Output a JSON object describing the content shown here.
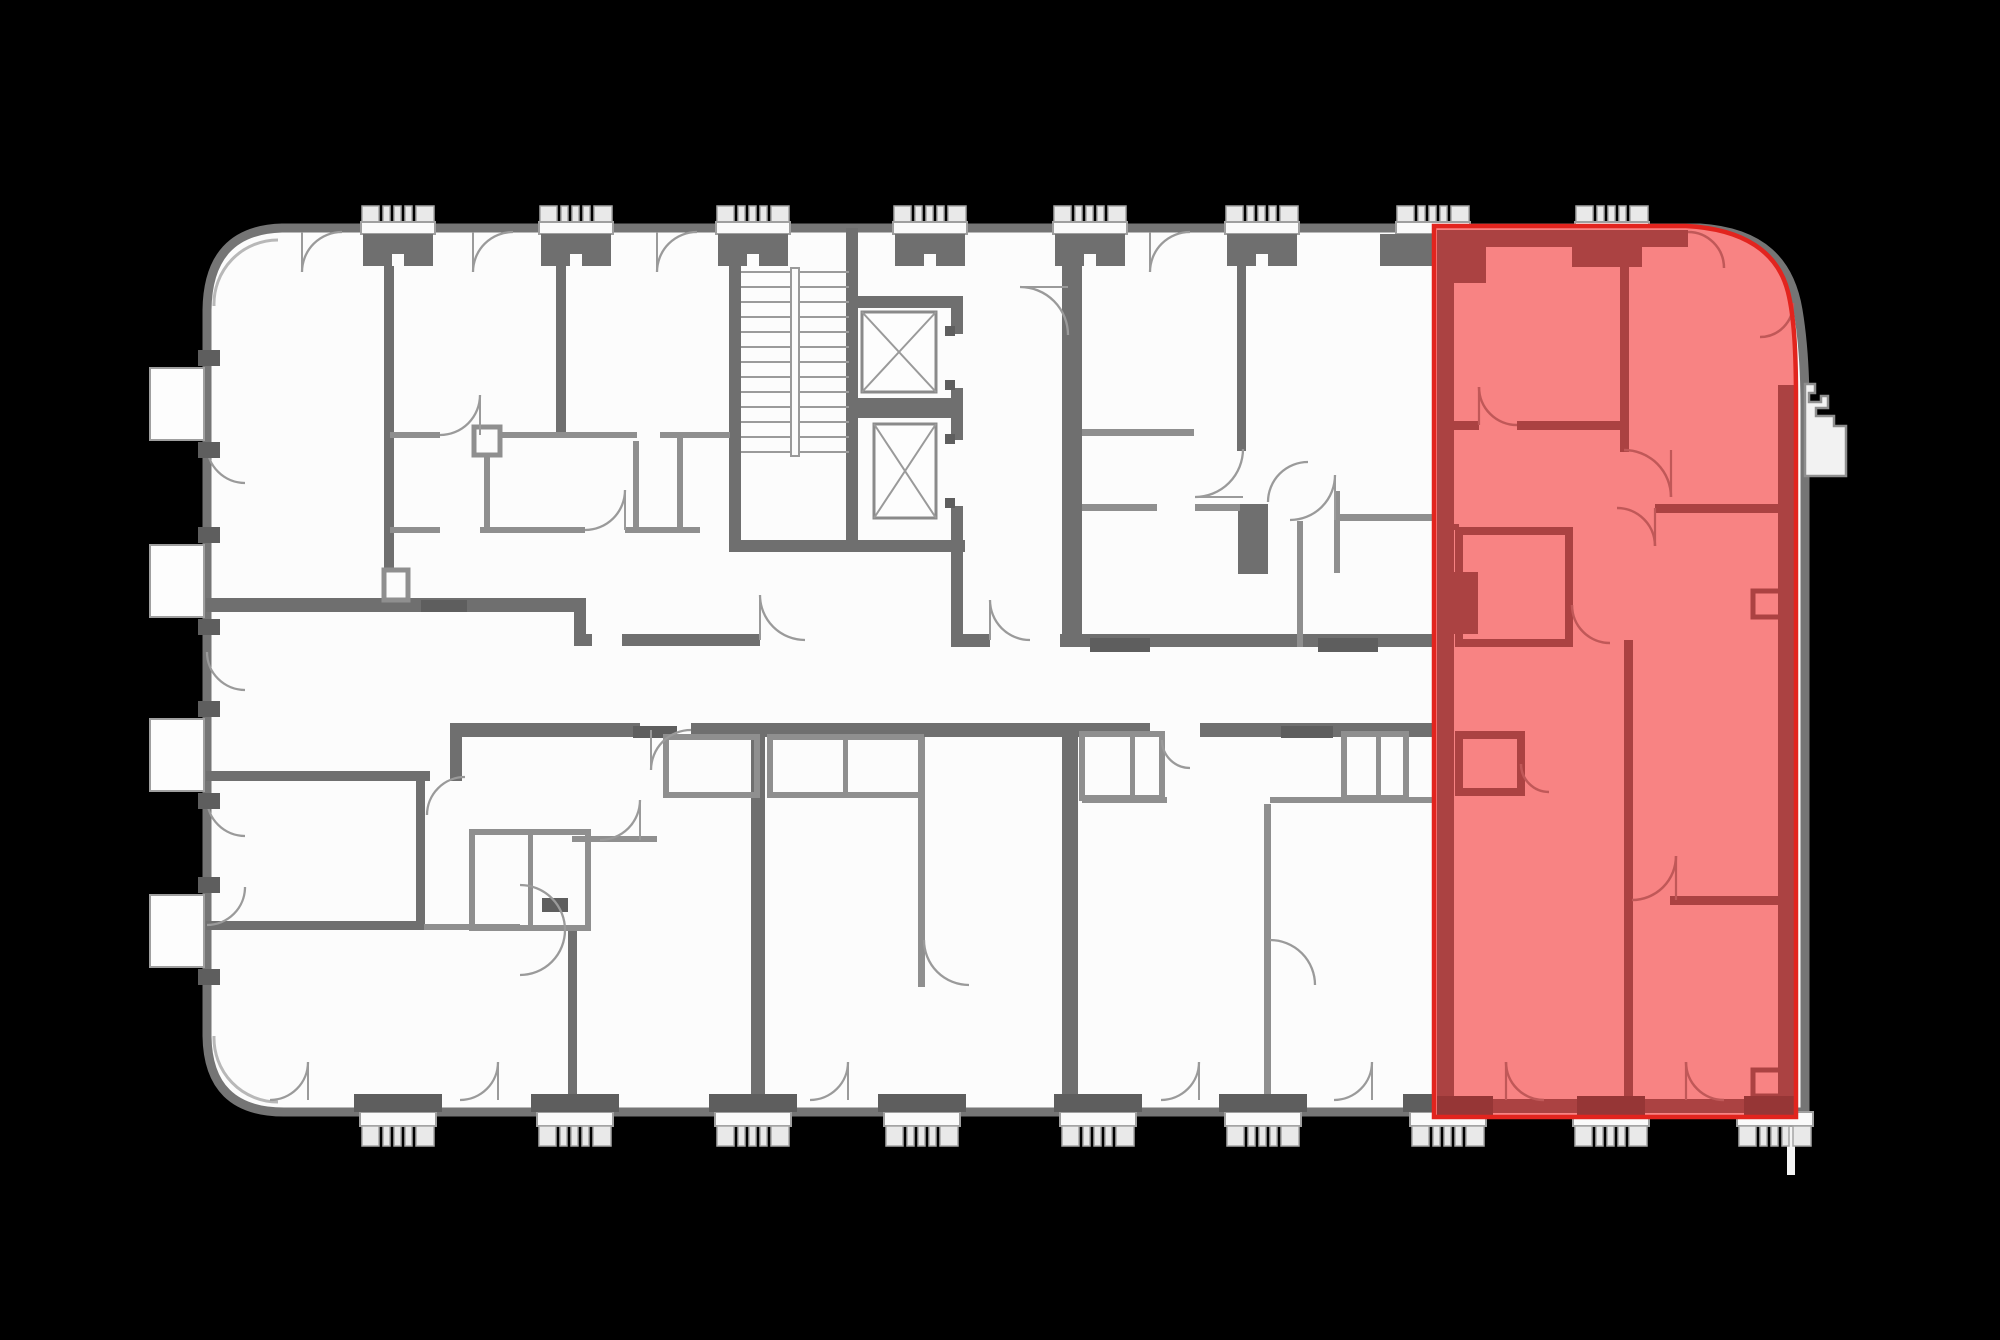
{
  "app": {
    "name": "floor-plan-viewer",
    "view": "building-floor-plan-with-highlighted-unit"
  },
  "colors": {
    "background": "#000000",
    "floor": "#fcfcfc",
    "wall": "#6f6f6f",
    "wall_thin": "#8f8f8f",
    "wall_outline": "#757575",
    "threshold": "#5e5e5e",
    "balcony_fill": "#fafafa",
    "highlight_fill": "#f88383",
    "highlight_outline": "#e2241e",
    "highlight_wall": "#ab4242",
    "highlight_line": "#c05858"
  },
  "floor_plan": {
    "highlighted_unit": {
      "position": "right-end",
      "state": "selected"
    },
    "features": {
      "top_balconies": 8,
      "bottom_balconies": 9,
      "left_windows": 4,
      "elevators": 2,
      "staircases": 1,
      "right_bay_window": 1
    }
  }
}
